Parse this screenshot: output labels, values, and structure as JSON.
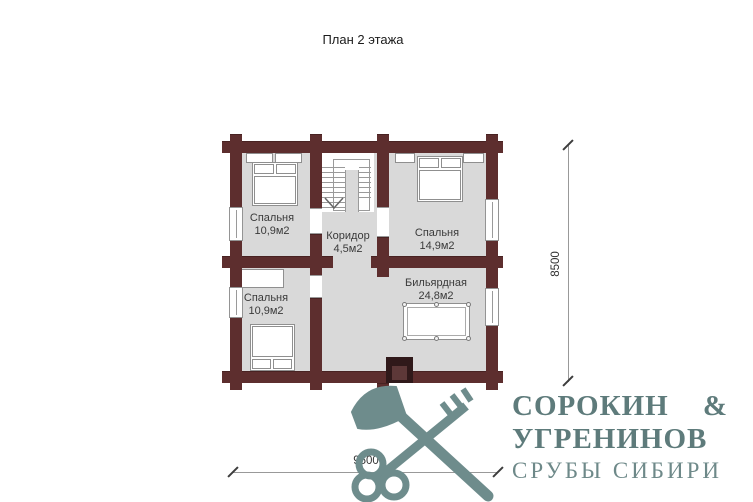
{
  "title": "План 2 этажа",
  "rooms": [
    {
      "name": "Спальня",
      "area": "10,9м2"
    },
    {
      "name": "Коридор",
      "area": "4,5м2"
    },
    {
      "name": "Спальня",
      "area": "14,9м2"
    },
    {
      "name": "Спальня",
      "area": "10,9м2"
    },
    {
      "name": "Бильярдная",
      "area": "24,8м2"
    }
  ],
  "dimensions": {
    "height": "8500",
    "width": "9500"
  },
  "logo": {
    "name_left": "СОРОКИН",
    "ampersand": "&",
    "name_line2": "УГРЕНИНОВ",
    "tagline": "СРУБЫ СИБИРИ",
    "icon": "axe-and-key"
  },
  "colors": {
    "wall": "#5d2e2e",
    "floor": "#d9d9d9",
    "logo_accent": "#6e8c8c",
    "fireplace_dark": "#30191a",
    "dimension_text": "#333333"
  }
}
